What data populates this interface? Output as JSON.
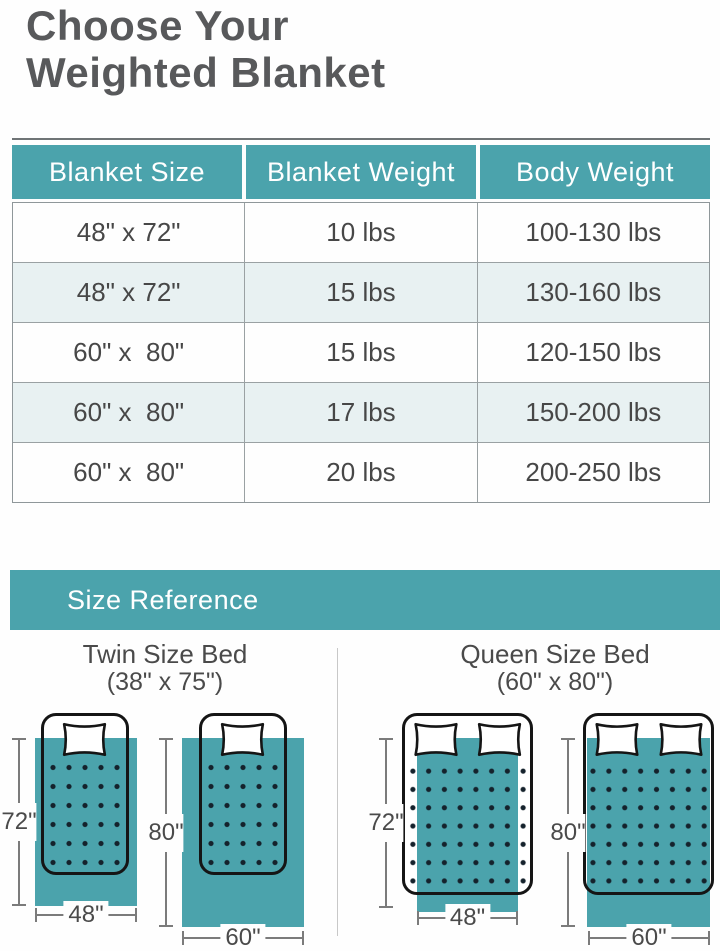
{
  "page": {
    "title_line1": "Choose Your",
    "title_line2": "Weighted Blanket"
  },
  "table": {
    "headers": [
      "Blanket Size",
      "Blanket Weight",
      "Body Weight"
    ],
    "rows": [
      [
        "48\" x 72\"",
        "10 lbs",
        "100-130 lbs"
      ],
      [
        "48\" x 72\"",
        "15 lbs",
        "130-160 lbs"
      ],
      [
        "60\" x  80\"",
        "15 lbs",
        "120-150 lbs"
      ],
      [
        "60\" x  80\"",
        "17 lbs",
        "150-200 lbs"
      ],
      [
        "60\" x  80\"",
        "20 lbs",
        "200-250 lbs"
      ]
    ]
  },
  "size_reference": {
    "banner_label": "Size Reference",
    "sections": [
      {
        "title": "Twin Size Bed",
        "subtitle": "(38\" x 75\")",
        "diagrams": [
          {
            "height_label": "72\"",
            "width_label": "48\""
          },
          {
            "height_label": "80\"",
            "width_label": "60\""
          }
        ]
      },
      {
        "title": "Queen Size Bed",
        "subtitle": "(60\" x 80\")",
        "diagrams": [
          {
            "height_label": "72\"",
            "width_label": "48\""
          },
          {
            "height_label": "80\"",
            "width_label": "60\""
          }
        ]
      }
    ]
  },
  "colors": {
    "teal": "#4BA3AC",
    "table_alt_row": "#E8F1F2",
    "title_text": "#58595B",
    "body_text": "#474747",
    "dimension_line": "#7B7B7B",
    "stitch_dot": "#15222C"
  }
}
